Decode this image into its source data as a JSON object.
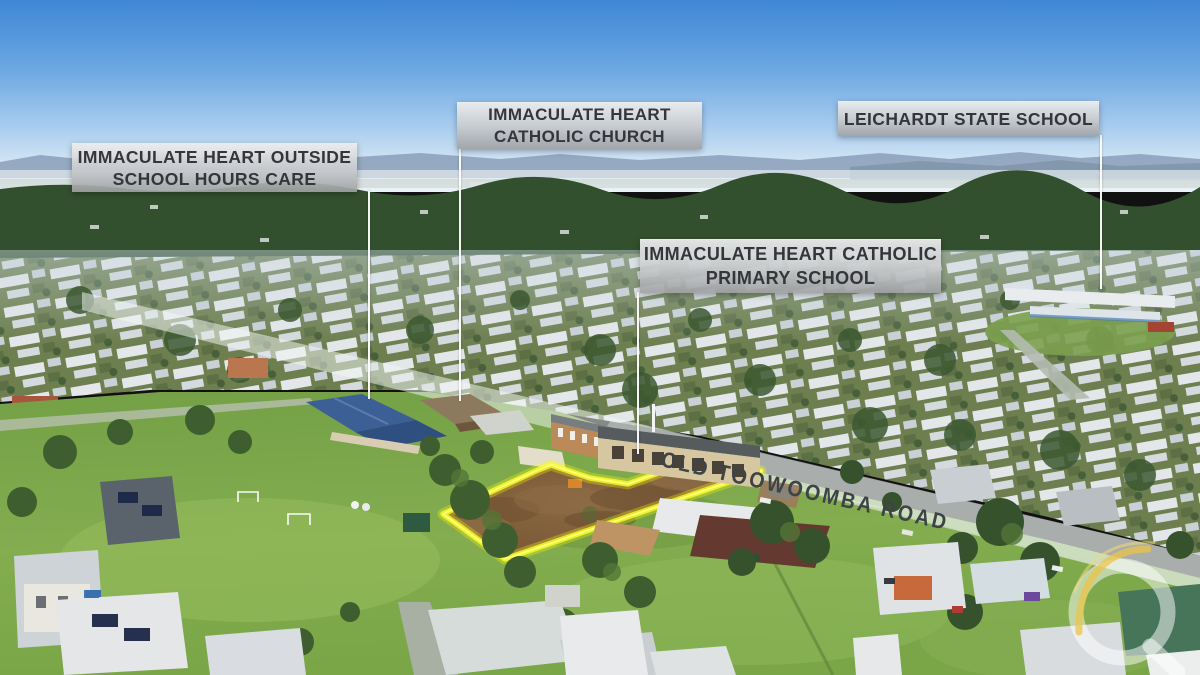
{
  "annotations": {
    "outside_school_hours_care": {
      "line1": "IMMACULATE HEART OUTSIDE",
      "line2": "SCHOOL HOURS CARE"
    },
    "catholic_church": {
      "line1": "IMMACULATE HEART",
      "line2": "CATHOLIC CHURCH"
    },
    "state_school": {
      "line1": "LEICHARDT STATE SCHOOL"
    },
    "catholic_primary_school": {
      "line1": "IMMACULATE HEART CATHOLIC",
      "line2": "PRIMARY SCHOOL"
    }
  },
  "road_label": {
    "text": "OLD TOOWOOMBA ROAD"
  },
  "property_highlight": {
    "outline_color": "#fbff00"
  },
  "watermark": {
    "icon": "q-logo-watermark",
    "ring_color": "rgba(255,255,255,0.5)",
    "swoosh_color": "#e9c44a"
  },
  "scene_colors": {
    "sky_top": "#3f87d5",
    "sky_horizon": "#ecf3f7",
    "grass": "#7fa84c",
    "cleared_land": "#7c5c3a",
    "label_text": "#343639",
    "road_text": "#3e4346"
  }
}
